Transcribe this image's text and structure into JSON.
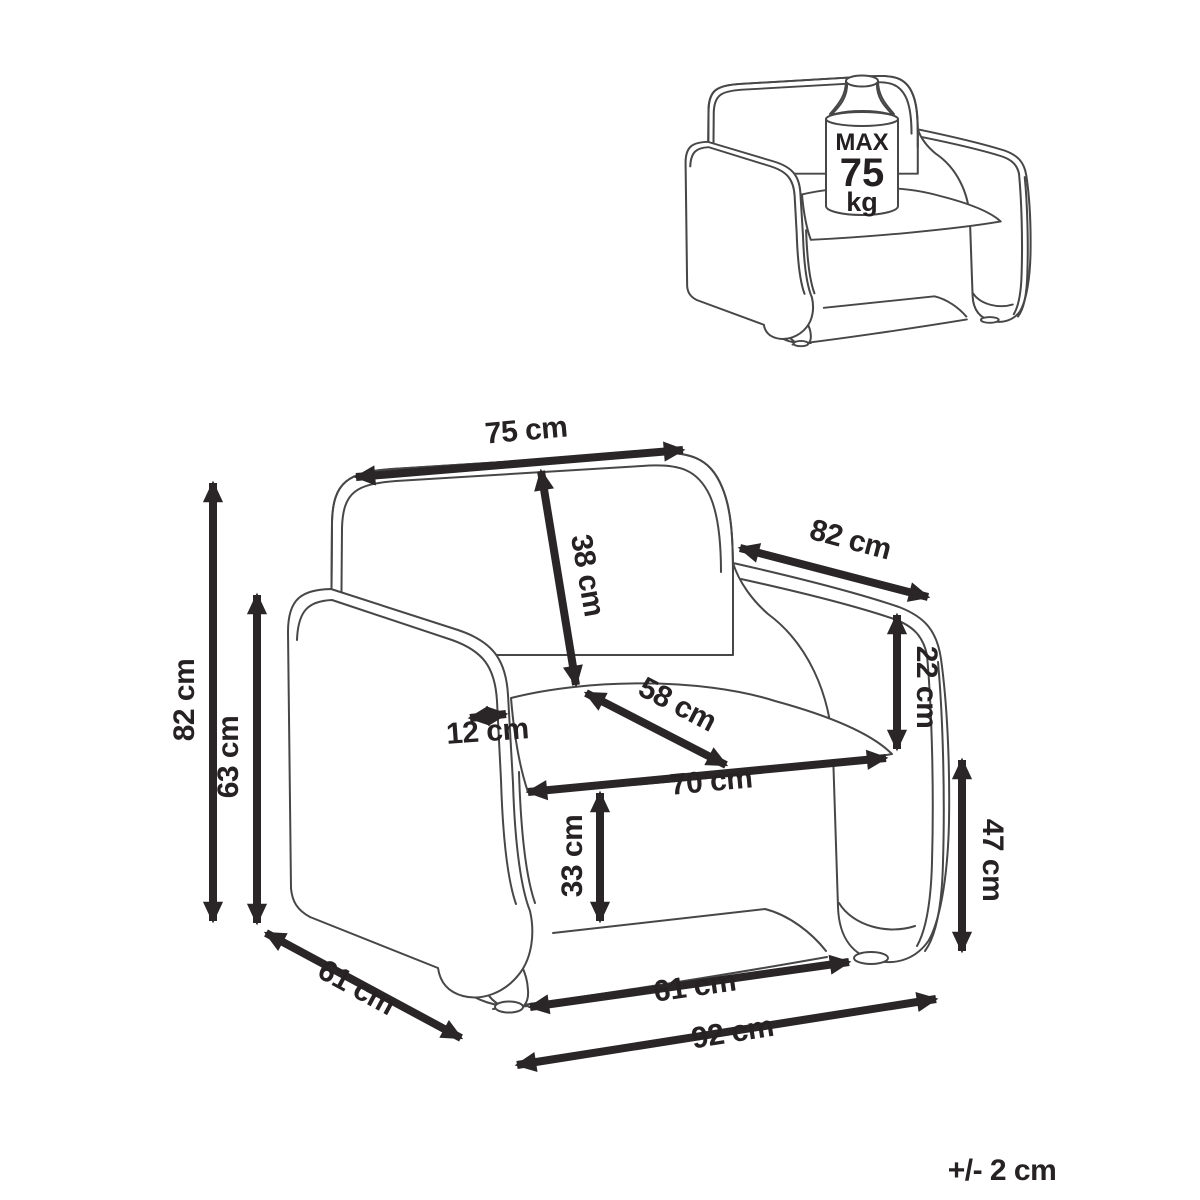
{
  "figure": {
    "type": "armchair dimension diagram",
    "tolerance_note": "+/- 2 cm"
  },
  "weight_limit": {
    "max_label": "MAX",
    "value": "75",
    "unit": "kg"
  },
  "dimensions": {
    "backrest_top_width": "75 cm",
    "backrest_height": "38 cm",
    "top_depth": "82 cm",
    "armrest_to_seat_height": "22 cm",
    "seat_depth": "58 cm",
    "armrest_thickness": "12 cm",
    "seat_width": "70 cm",
    "seat_height": "33 cm",
    "armrest_front_height": "47 cm",
    "front_base_width": "61 cm",
    "overall_width": "92 cm",
    "side_depth": "61 cm",
    "overall_height": "82 cm",
    "armrest_height": "63 cm"
  }
}
